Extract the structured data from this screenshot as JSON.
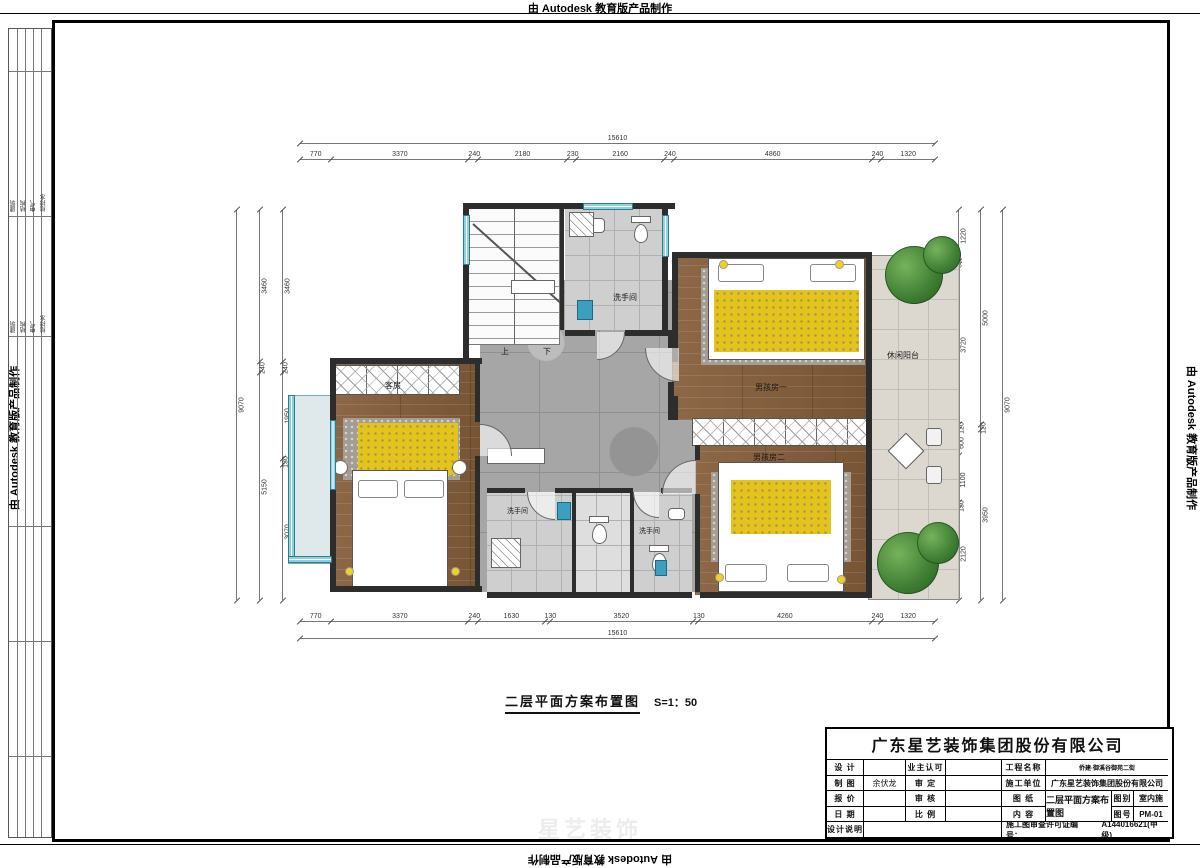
{
  "watermark": {
    "top": "由 Autodesk 教育版产品制作",
    "bottom": "由 Autodesk 教育版产品制作",
    "left": "由 Autodesk 教育版产品制作",
    "right": "由 Autodesk 教育版产品制作"
  },
  "ghost_logo": "星艺装饰",
  "side_table": {
    "groups": [
      {
        "cols": [
          "建筑",
          "结构",
          "电气",
          "给排水"
        ]
      },
      {
        "cols": [
          "建筑",
          "结构",
          "电气",
          "给排水"
        ]
      }
    ]
  },
  "caption": {
    "title": "二层平面方案布置图",
    "scale": "S=1：50"
  },
  "plan": {
    "labels": {
      "guest_room": "客房",
      "bath_top": "洗手间",
      "bath_bottom_left": "洗手间",
      "bath_bottom_right": "洗手间",
      "leisure_balcony": "休闲阳台",
      "boy_room_1": "男孩房一",
      "boy_room_2": "男孩房二",
      "stair_up": "上",
      "stair_down": "下"
    },
    "dims": {
      "top_total": [
        "15610"
      ],
      "top_segments": [
        "770",
        "3370",
        "240",
        "2180",
        "230",
        "2160",
        "240",
        "4860",
        "240",
        "1320"
      ],
      "bottom_segments": [
        "770",
        "3370",
        "240",
        "1630",
        "130",
        "3520",
        "130",
        "4260",
        "240",
        "1320"
      ],
      "bottom_total": [
        "15610"
      ],
      "left_total": [
        "9070"
      ],
      "left_mid": [
        "3460",
        "240",
        "5150"
      ],
      "left_inner": [
        "3460",
        "240",
        "1950",
        "130",
        "3070"
      ],
      "right_inner": [
        "1220",
        "60",
        "3720",
        "120",
        "600",
        "1100",
        "130",
        "2120"
      ],
      "right_mid": [
        "5000",
        "120",
        "3950"
      ],
      "right_total": [
        "9070"
      ]
    }
  },
  "titleblock": {
    "company": "广东星艺装饰集团股份有限公司",
    "cells": {
      "r1c1": "设 计",
      "r1c2": "",
      "r1c3": "业主认可",
      "r1c4": "",
      "r1c5": "工程名称",
      "r1c6": "侨建·御溪谷御苑二街",
      "r2c1": "制 图",
      "r2c2": "余伏龙",
      "r2c3": "审 定",
      "r2c4": "",
      "r2c5": "施工单位",
      "r2c6": "广东星艺装饰集团股份有限公司",
      "r3c1": "报 价",
      "r3c2": "",
      "r3c3": "审 核",
      "r3c4": "",
      "r3c5": "图 纸",
      "r4c1": "日 期",
      "r4c2": "",
      "r4c3": "比 例",
      "r4c4": "",
      "r4c5": "内 容",
      "content": "二层平面方案布置图",
      "tubie_label": "图别",
      "tubie_value": "室内施",
      "tuhao_label": "图号",
      "tuhao_value": "PM-01",
      "note": "设计说明",
      "permit_label": "施工图审查许可证编号：",
      "permit_no": "A144016621(甲级)"
    }
  },
  "colors": {
    "wall": "#2d2d2d",
    "wood": "#86603f",
    "marble": "#a6a6a6",
    "accent_yellow": "#e3c31c",
    "window_cyan": "#8fd0df",
    "tree_green": "#3e7d33"
  }
}
